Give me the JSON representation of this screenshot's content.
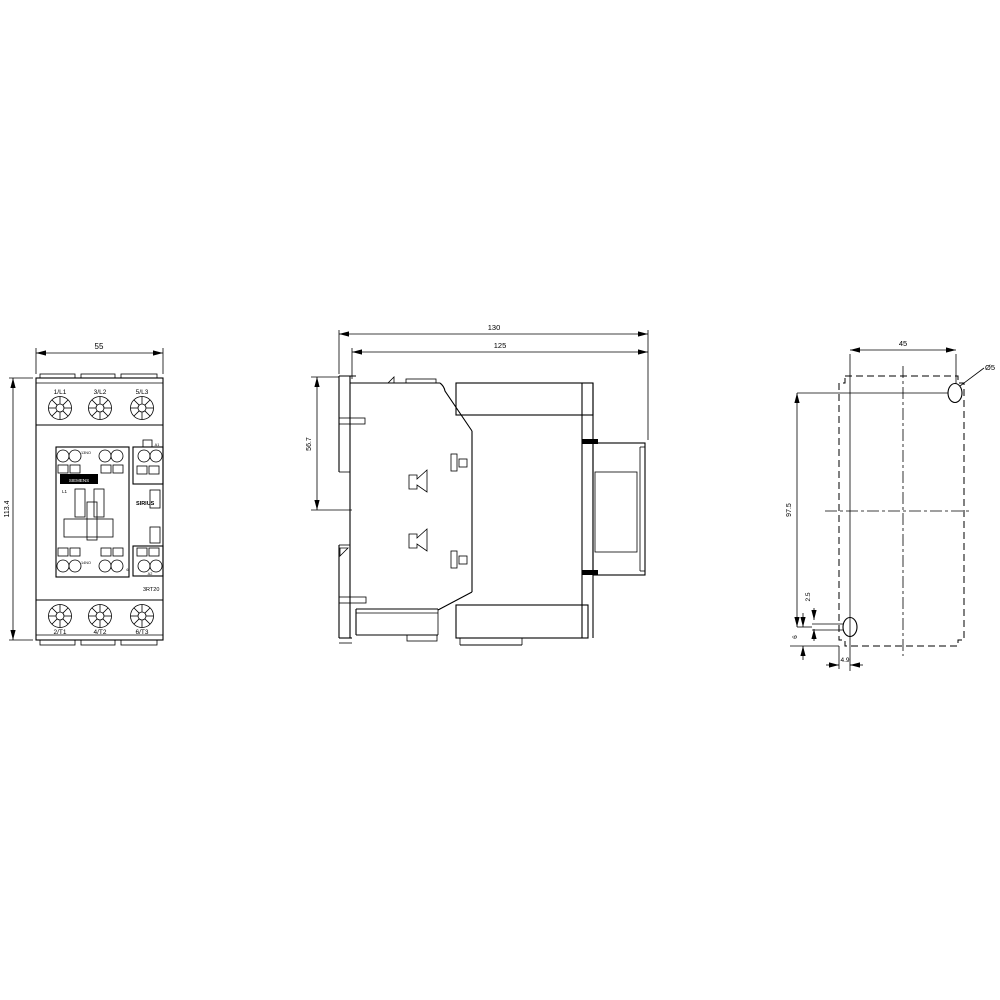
{
  "colors": {
    "line": "#000000",
    "background": "#ffffff"
  },
  "front_view": {
    "dim_width": "55",
    "dim_height": "113.4",
    "terminals_top": [
      "1/L1",
      "3/L2",
      "5/L3"
    ],
    "terminals_bottom": [
      "2/T1",
      "4/T2",
      "6/T3"
    ],
    "brand_plate": "SIEMENS",
    "phase_label": "L1",
    "aux_label_top": "13NO",
    "aux_label_bottom": "14NO",
    "coil_label_top": "A1",
    "coil_label_bottom": "A2",
    "terminal_label": "6.",
    "family_label": "SIRIUS",
    "product_label": "3RT20"
  },
  "side_view": {
    "dim_total_depth": "130",
    "dim_body_depth": "125",
    "dim_rail_offset": "56.7"
  },
  "drill_plan": {
    "dim_hole_spacing_h": "45",
    "hole_diameter": "Ø5",
    "dim_hole_spacing_v": "97.5",
    "dim_slot_offset": "2.5",
    "dim_bottom_offset": "6",
    "dim_slot_width": "4.9"
  }
}
